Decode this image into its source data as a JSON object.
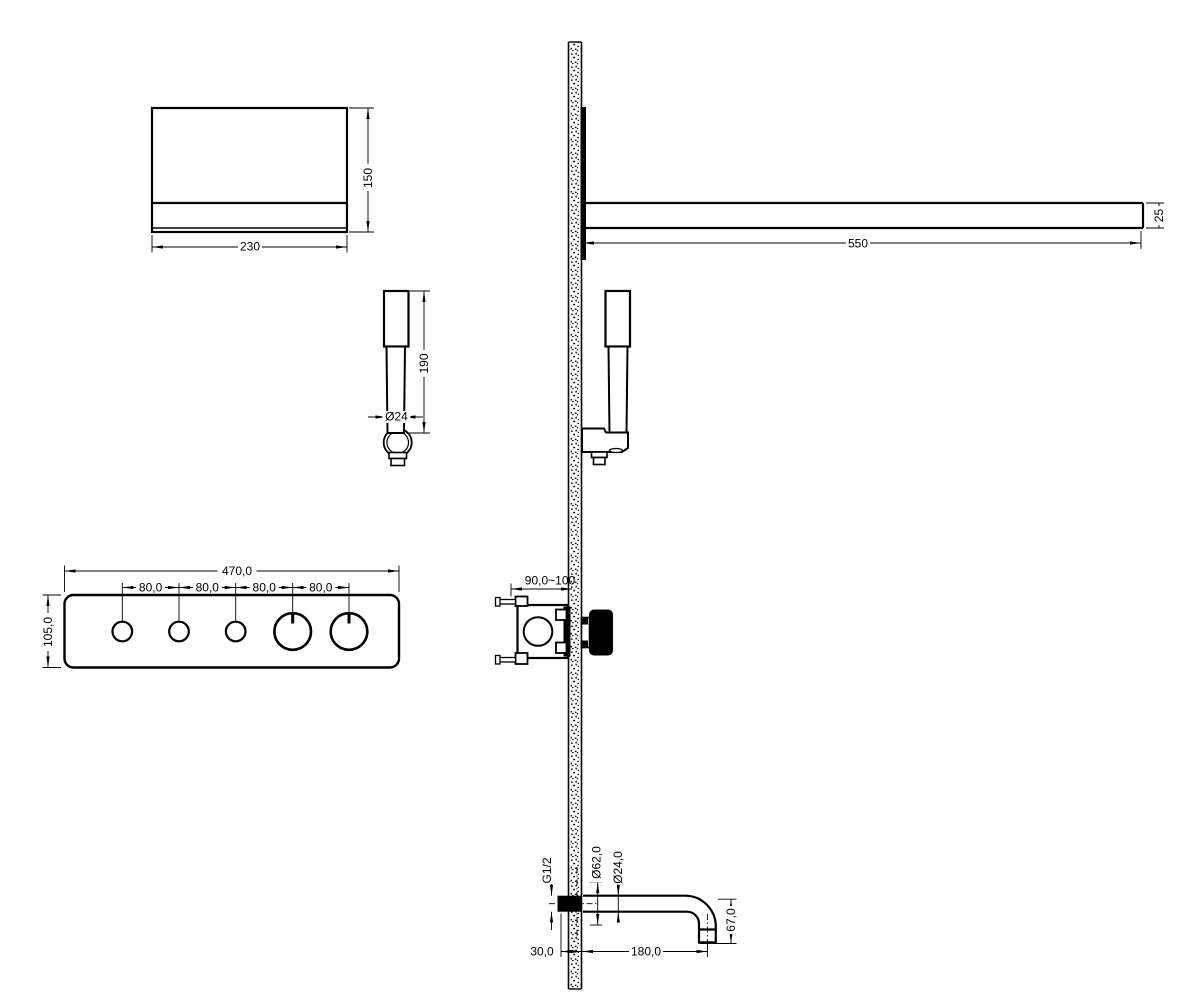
{
  "drawing": {
    "background": "#ffffff",
    "line_color": "#000000",
    "views": {
      "showerhead_front": {
        "dim_width": "230",
        "dim_height": "150"
      },
      "shower_arm_side": {
        "dim_length": "550",
        "dim_thickness": "25"
      },
      "handshower_front": {
        "dim_height": "190",
        "dim_diameter": "Ø24"
      },
      "control_panel": {
        "dim_width": "470,0",
        "dim_height": "105,0",
        "dim_spacing": [
          "80,0",
          "80,0",
          "80,0",
          "80,0"
        ],
        "small_knob_count": 3,
        "large_knob_count": 2
      },
      "valve_side": {
        "dim_depth": "90,0~100"
      },
      "spout_side": {
        "dim_thread": "G1/2",
        "dim_flange": "Ø62,0",
        "dim_pipe": "Ø24,0",
        "dim_drop": "67,0",
        "dim_reach": "180,0",
        "dim_wall": "30,0"
      }
    }
  }
}
